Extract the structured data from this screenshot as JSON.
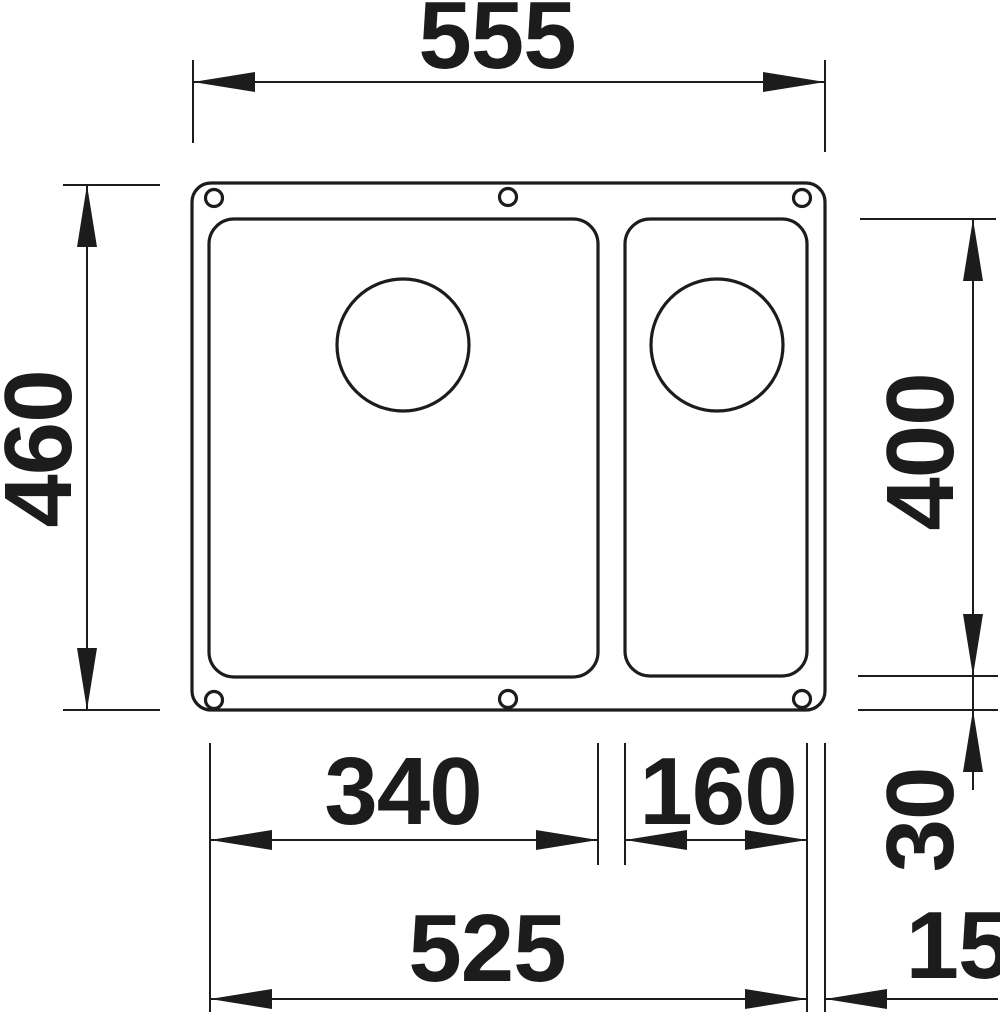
{
  "drawing": {
    "type": "technical-dimension-drawing",
    "subject": "undermount kitchen sink with main bowl and half bowl, top view",
    "unit": "mm",
    "labels": {
      "overall_width": "555",
      "overall_depth": "460",
      "bowl_depth": "400",
      "main_bowl_width": "340",
      "small_bowl_width": "160",
      "cutout_width": "525",
      "edge_gap": "15",
      "front_gap": "30"
    },
    "colors": {
      "line": "#1c1c1c",
      "background": "#ffffff"
    }
  }
}
